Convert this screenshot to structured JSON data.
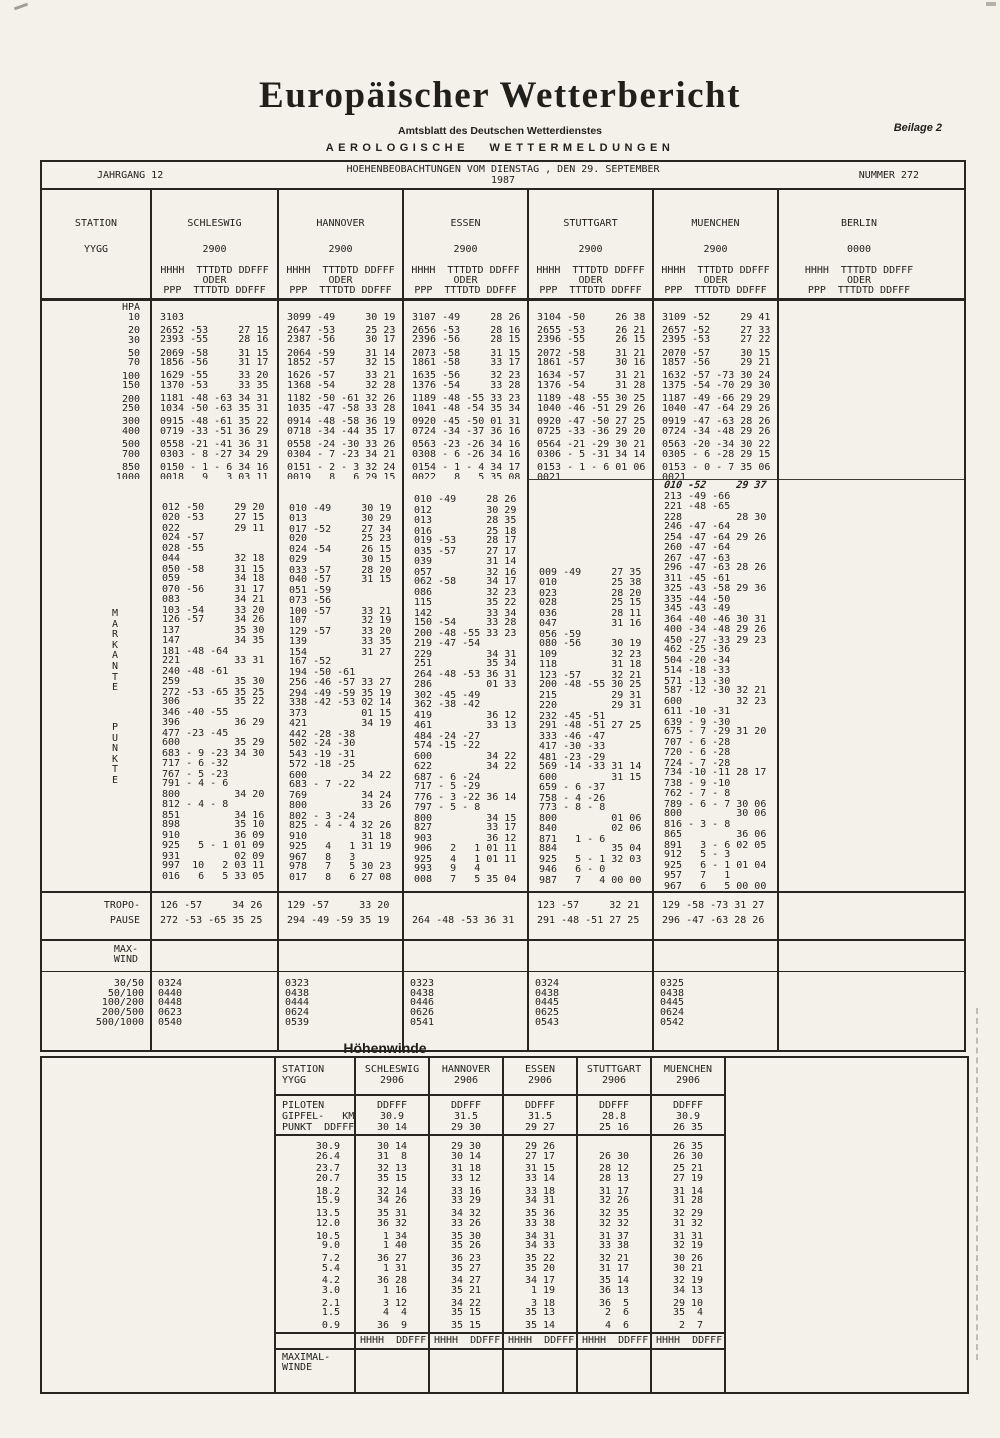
{
  "page": {
    "title": "Europäischer Wetterbericht",
    "subtitle": "Amtsblatt des Deutschen Wetterdienstes",
    "beilage": "Beilage 2",
    "section": "AEROLOGISCHE WETTERMELDUNGEN"
  },
  "masthead": {
    "jahrgang": "JAHRGANG  12",
    "observation": "HOEHENBEOBACHTUNGEN VOM DIENSTAG , DEN 29. SEPTEMBER 1987",
    "nummer": "NUMMER 272"
  },
  "main_table": {
    "station_label": "STATION",
    "yygg_label": "YYGG",
    "hpa_label": "HPA",
    "column_header": [
      "HHHH  TTTDTD DDFFF",
      "ODER",
      "PPP  TTTDTD DDFFF"
    ],
    "stations": [
      {
        "name": "SCHLESWIG",
        "yygg": "2900"
      },
      {
        "name": "HANNOVER",
        "yygg": "2900"
      },
      {
        "name": "ESSEN",
        "yygg": "2900"
      },
      {
        "name": "STUTTGART",
        "yygg": "2900"
      },
      {
        "name": "MUENCHEN",
        "yygg": "2900"
      },
      {
        "name": "BERLIN",
        "yygg": "0000"
      }
    ],
    "pressure_levels": {
      "rows": [
        {
          "hpa": "10",
          "gap": false,
          "cells": [
            "3103",
            "3099 -49     30 19",
            "3107 -49     28 26",
            "3104 -50     26 38",
            "3109 -52     29 41",
            ""
          ]
        },
        {
          "hpa": "20",
          "gap": true,
          "cells": [
            "2652 -53     27 15",
            "2647 -53     25 23",
            "2656 -53     28 16",
            "2655 -53     26 21",
            "2657 -52     27 33",
            ""
          ]
        },
        {
          "hpa": "30",
          "gap": false,
          "cells": [
            "2393 -55     28 16",
            "2387 -56     30 17",
            "2396 -56     28 15",
            "2396 -55     26 15",
            "2395 -53     27 22",
            ""
          ]
        },
        {
          "hpa": "50",
          "gap": true,
          "cells": [
            "2069 -58     31 15",
            "2064 -59     31 14",
            "2073 -58     31 15",
            "2072 -58     31 21",
            "2070 -57     30 15",
            ""
          ]
        },
        {
          "hpa": "70",
          "gap": false,
          "cells": [
            "1856 -56     31 17",
            "1852 -57     32 15",
            "1861 -58     33 17",
            "1861 -57     30 16",
            "1857 -56     29 21",
            ""
          ]
        },
        {
          "hpa": "100",
          "gap": true,
          "cells": [
            "1629 -55     33 20",
            "1626 -57     33 21",
            "1635 -56     32 23",
            "1634 -57     31 21",
            "1632 -57 -73 30 24",
            ""
          ]
        },
        {
          "hpa": "150",
          "gap": false,
          "cells": [
            "1370 -53     33 35",
            "1368 -54     32 28",
            "1376 -54     33 28",
            "1376 -54     31 28",
            "1375 -54 -70 29 30",
            ""
          ]
        },
        {
          "hpa": "200",
          "gap": true,
          "cells": [
            "1181 -48 -63 34 31",
            "1182 -50 -61 32 26",
            "1189 -48 -55 33 23",
            "1189 -48 -55 30 25",
            "1187 -49 -66 29 29",
            ""
          ]
        },
        {
          "hpa": "250",
          "gap": false,
          "cells": [
            "1034 -50 -63 35 31",
            "1035 -47 -58 33 28",
            "1041 -48 -54 35 34",
            "1040 -46 -51 29 26",
            "1040 -47 -64 29 26",
            ""
          ]
        },
        {
          "hpa": "300",
          "gap": true,
          "cells": [
            "0915 -48 -61 35 22",
            "0914 -48 -58 36 19",
            "0920 -45 -50 01 31",
            "0920 -47 -50 27 25",
            "0919 -47 -63 28 26",
            ""
          ]
        },
        {
          "hpa": "400",
          "gap": false,
          "cells": [
            "0719 -33 -51 36 29",
            "0718 -34 -44 35 17",
            "0724 -34 -37 36 16",
            "0725 -33 -36 29 20",
            "0724 -34 -48 29 26",
            ""
          ]
        },
        {
          "hpa": "500",
          "gap": true,
          "cells": [
            "0558 -21 -41 36 31",
            "0558 -24 -30 33 26",
            "0563 -23 -26 34 16",
            "0564 -21 -29 30 21",
            "0563 -20 -34 30 22",
            ""
          ]
        },
        {
          "hpa": "700",
          "gap": false,
          "cells": [
            "0303 - 8 -27 34 29",
            "0304 - 7 -23 34 21",
            "0308 - 6 -26 34 16",
            "0306 - 5 -31 34 14",
            "0305 - 6 -28 29 15",
            ""
          ]
        },
        {
          "hpa": "850",
          "gap": true,
          "cells": [
            "0150 - 1 - 6 34 16",
            "0151 - 2 - 3 32 24",
            "0154 - 1 - 4 34 17",
            "0153 - 1 - 6 01 06",
            "0153 - 0 - 7 35 06",
            ""
          ]
        },
        {
          "hpa": "1000",
          "gap": false,
          "cells": [
            "0018   9   3 03 11",
            "0019   8   6 29 15",
            "0022   8   5 35 08",
            "0021",
            "0021",
            ""
          ]
        }
      ]
    },
    "significant_points": {
      "vertical_label": [
        "MARKANTE",
        "PUNKTE"
      ],
      "columns": [
        {
          "station": "SCHLESWIG",
          "solo_first": false,
          "handwritten_first": false,
          "lines": [
            "012 -50     29 20",
            "020 -53     27 15",
            "022         29 11",
            "024 -57",
            "028 -55",
            "044         32 18",
            "050 -58     31 15",
            "059         34 18",
            "070 -56     31 17",
            "083         34 21",
            "103 -54     33 20",
            "126 -57     34 26",
            "137         35 30",
            "147         34 35",
            "181 -48 -64",
            "221         33 31",
            "240 -48 -61",
            "259         35 30",
            "272 -53 -65 35 25",
            "306         35 22",
            "346 -40 -55",
            "396         36 29",
            "477 -23 -45",
            "600         35 29",
            "683 - 9 -23 34 30",
            "717 - 6 -32",
            "767 - 5 -23",
            "791 - 4 - 6",
            "800         34 20",
            "812 - 4 - 8",
            "851         34 16",
            "898         35 10",
            "910         36 09",
            "925   5 - 1 01 09",
            "931         02 09",
            "997  10   2 03 11",
            "016   6   5 33 05"
          ]
        },
        {
          "station": "HANNOVER",
          "solo_first": false,
          "handwritten_first": false,
          "lines": [
            "010 -49     30 19",
            "013         30 29",
            "017 -52     27 34",
            "020         25 23",
            "024 -54     26 15",
            "029         30 15",
            "033 -57     28 20",
            "040 -57     31 15",
            "051 -59",
            "073 -56",
            "100 -57     33 21",
            "107         32 19",
            "129 -57     33 20",
            "139         33 35",
            "154         31 27",
            "167 -52",
            "194 -50 -61",
            "256 -46 -57 33 27",
            "294 -49 -59 35 19",
            "338 -42 -53 02 14",
            "373         01 15",
            "421         34 19",
            "442 -28 -38",
            "502 -24 -30",
            "543 -19 -31",
            "572 -18 -25",
            "600         34 22",
            "683 - 7 -22",
            "769         34 24",
            "800         33 26",
            "802 - 3 -24",
            "825 - 4 - 4 32 26",
            "910         31 18",
            "925   4   1 31 19",
            "967   8   3",
            "978   7   5 30 23",
            "017   8   6 27 08"
          ]
        },
        {
          "station": "ESSEN",
          "solo_first": true,
          "handwritten_first": false,
          "lines": [
            "010 -49     28 26",
            "012         30 29",
            "013         28 35",
            "016         25 18",
            "019 -53     28 17",
            "035 -57     27 17",
            "039         31 14",
            "057         32 16",
            "062 -58     34 17",
            "086         32 23",
            "115         35 22",
            "142         33 34",
            "150 -54     33 28",
            "200 -48 -55 33 23",
            "219 -47 -54",
            "229         34 31",
            "251         35 34",
            "264 -48 -53 36 31",
            "286         01 33",
            "302 -45 -49",
            "362 -38 -42",
            "419         36 12",
            "461         33 13",
            "484 -24 -27",
            "574 -15 -22",
            "600         34 22",
            "622         34 22",
            "687 - 6 -24",
            "717 - 5 -29",
            "776 - 3 -22 36 14",
            "797 - 5 - 8",
            "800         34 15",
            "827         33 17",
            "903         36 12",
            "906   2   1 01 11",
            "925   4   1 01 11",
            "993   9   4",
            "008   7   5 35 04"
          ]
        },
        {
          "station": "STUTTGART",
          "solo_first": false,
          "handwritten_first": false,
          "lines": [
            "009 -49     27 35",
            "010         25 38",
            "023         28 20",
            "028         25 15",
            "036         28 11",
            "047         31 16",
            "056 -59",
            "080 -56     30 19",
            "109         32 23",
            "118         31 18",
            "123 -57     32 21",
            "200 -48 -55 30 25",
            "215         29 31",
            "220         29 31",
            "232 -45 -51",
            "291 -48 -51 27 25",
            "333 -46 -47",
            "417 -30 -33",
            "481 -23 -29",
            "569 -14 -33 31 14",
            "600         31 15",
            "659 - 6 -37",
            "758 - 4 -26",
            "773 - 8 - 8",
            "800         01 06",
            "840         02 06",
            "871   1 - 6",
            "884         35 04",
            "925   5 - 1 32 03",
            "946   6 - 0",
            "987   7   4 00 00"
          ]
        },
        {
          "station": "MUENCHEN",
          "solo_first": true,
          "handwritten_first": true,
          "lines": [
            "010 -52     29 37",
            "213 -49 -66",
            "221 -48 -65",
            "228         28 30",
            "246 -47 -64",
            "254 -47 -64 29 26",
            "260 -47 -64",
            "267 -47 -63",
            "296 -47 -63 28 26",
            "311 -45 -61",
            "325 -43 -58 29 36",
            "335 -44 -50",
            "345 -43 -49",
            "364 -40 -46 30 31",
            "400 -34 -48 29 26",
            "450 -27 -33 29 23",
            "462 -25 -36",
            "504 -20 -34",
            "514 -18 -33",
            "571 -13 -30",
            "587 -12 -30 32 21",
            "600         32 23",
            "611 -10 -31",
            "639 - 9 -30",
            "675 - 7 -29 31 20",
            "707 - 6 -28",
            "720 - 6 -28",
            "724 - 7 -28",
            "734 -10 -11 28 17",
            "738 - 9 -10",
            "762 - 7 - 8",
            "789 - 6 - 7 30 06",
            "800         30 06",
            "816 - 3 - 8",
            "865         36 06",
            "891   3 - 6 02 05",
            "912   5 - 3",
            "925   6 - 1 01 04",
            "957   7   1",
            "967   6   5 00 00"
          ]
        },
        {
          "station": "BERLIN",
          "solo_first": false,
          "handwritten_first": false,
          "lines": []
        }
      ]
    },
    "tropopause": {
      "label": [
        "TROPO-",
        "PAUSE"
      ],
      "cells": [
        [
          "126 -57     34 26",
          "272 -53 -65 35 25"
        ],
        [
          "129 -57     33 20",
          "294 -49 -59 35 19"
        ],
        [
          "",
          "264 -48 -53 36 31"
        ],
        [
          "123 -57     32 21",
          "291 -48 -51 27 25"
        ],
        [
          "129 -58 -73 31 27",
          "296 -47 -63 28 26"
        ],
        [
          "",
          ""
        ]
      ]
    },
    "max_wind": {
      "label": [
        "MAX-",
        "WIND"
      ],
      "row_labels": [
        "30/50",
        "50/100",
        "100/200",
        "200/500",
        "500/1000"
      ],
      "cells": [
        [
          "0324",
          "0440",
          "0448",
          "0623",
          "0540"
        ],
        [
          "0323",
          "0438",
          "0444",
          "0624",
          "0539"
        ],
        [
          "0323",
          "0438",
          "0446",
          "0626",
          "0541"
        ],
        [
          "0324",
          "0438",
          "0445",
          "0625",
          "0543"
        ],
        [
          "0325",
          "0438",
          "0445",
          "0624",
          "0542"
        ],
        [
          "",
          "",
          "",
          "",
          ""
        ]
      ]
    }
  },
  "hoehenwinde": {
    "title": "Höhenwinde",
    "station_label": "STATION",
    "yygg_label": "YYGG",
    "piloten_label": "PILOTEN",
    "gipfel_label": "GIPFEL-   KM",
    "punkt_label": "PUNKT  DDFFF",
    "ddfff": "DDFFF",
    "stations": [
      {
        "name": "SCHLESWIG",
        "yygg": "2906",
        "gipfel": "30.9",
        "punkt": "30 14"
      },
      {
        "name": "HANNOVER",
        "yygg": "2906",
        "gipfel": "31.5",
        "punkt": "29 30"
      },
      {
        "name": "ESSEN",
        "yygg": "2906",
        "gipfel": "31.5",
        "punkt": "29 27"
      },
      {
        "name": "STUTTGART",
        "yygg": "2906",
        "gipfel": "28.8",
        "punkt": "25 16"
      },
      {
        "name": "MUENCHEN",
        "yygg": "2906",
        "gipfel": "30.9",
        "punkt": "26 35"
      }
    ],
    "wind_rows": [
      {
        "km": "30.9",
        "gap": false,
        "winds": [
          "30 14",
          "29 30",
          "29 26",
          "",
          "26 35"
        ]
      },
      {
        "km": "26.4",
        "gap": false,
        "winds": [
          "31  8",
          "30 14",
          "27 17",
          "26 30",
          "26 30"
        ]
      },
      {
        "km": "23.7",
        "gap": true,
        "winds": [
          "32 13",
          "31 18",
          "31 15",
          "28 12",
          "25 21"
        ]
      },
      {
        "km": "20.7",
        "gap": false,
        "winds": [
          "35 15",
          "33 12",
          "33 14",
          "28 13",
          "27 19"
        ]
      },
      {
        "km": "18.2",
        "gap": true,
        "winds": [
          "32 14",
          "33 16",
          "33 18",
          "31 17",
          "31 14"
        ]
      },
      {
        "km": "15.9",
        "gap": false,
        "winds": [
          "34 26",
          "33 29",
          "34 31",
          "32 26",
          "31 28"
        ]
      },
      {
        "km": "13.5",
        "gap": true,
        "winds": [
          "35 31",
          "34 32",
          "35 36",
          "32 35",
          "32 29"
        ]
      },
      {
        "km": "12.0",
        "gap": false,
        "winds": [
          "36 32",
          "33 26",
          "33 38",
          "32 32",
          "31 32"
        ]
      },
      {
        "km": "10.5",
        "gap": true,
        "winds": [
          " 1 34",
          "35 30",
          "34 31",
          "31 37",
          "31 31"
        ]
      },
      {
        "km": " 9.0",
        "gap": false,
        "winds": [
          " 1 40",
          "35 26",
          "34 33",
          "33 38",
          "32 19"
        ]
      },
      {
        "km": " 7.2",
        "gap": true,
        "winds": [
          "36 27",
          "36 23",
          "35 22",
          "32 21",
          "30 26"
        ]
      },
      {
        "km": " 5.4",
        "gap": false,
        "winds": [
          " 1 31",
          "35 27",
          "35 20",
          "31 17",
          "30 21"
        ]
      },
      {
        "km": " 4.2",
        "gap": true,
        "winds": [
          "36 28",
          "34 27",
          "34 17",
          "35 14",
          "32 19"
        ]
      },
      {
        "km": " 3.0",
        "gap": false,
        "winds": [
          " 1 16",
          "35 21",
          " 1 19",
          "36 13",
          "34 13"
        ]
      },
      {
        "km": " 2.1",
        "gap": true,
        "winds": [
          " 3 12",
          "34 22",
          " 3 18",
          "36  5",
          "29 10"
        ]
      },
      {
        "km": " 1.5",
        "gap": false,
        "winds": [
          " 4  4",
          "35 15",
          "35 13",
          " 2  6",
          "35  4"
        ]
      },
      {
        "km": " 0.9",
        "gap": true,
        "winds": [
          "36  9",
          "35 15",
          "35 14",
          " 4  6",
          " 2  7"
        ]
      }
    ],
    "bottom_header": "HHHH  DDFFF",
    "maximal_label": [
      "MAXIMAL-",
      "WINDE"
    ]
  }
}
